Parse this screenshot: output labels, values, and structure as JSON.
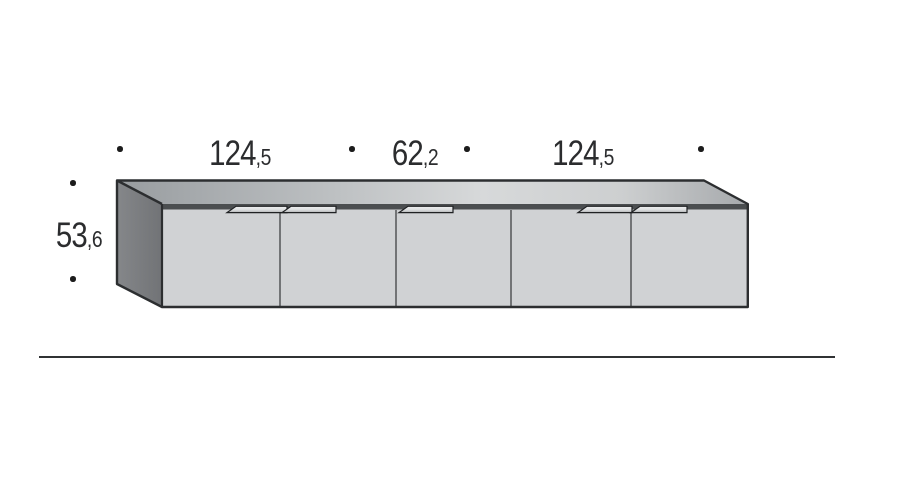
{
  "diagram": {
    "dimension_labels": {
      "top": [
        {
          "whole": "124",
          "decimal": ",5"
        },
        {
          "whole": "62",
          "decimal": ",2"
        },
        {
          "whole": "124",
          "decimal": ",5"
        }
      ],
      "height": {
        "whole": "53",
        "decimal": ",6"
      }
    },
    "cabinet": {
      "door_count": 5,
      "handle_count": 5
    },
    "colors": {
      "outline": "#2c2e30",
      "door_front": "#d0d2d4",
      "door_separator": "#4a4c4e",
      "side_panel_light": "#85878a",
      "side_panel_dark": "#717376",
      "top_edge_band": "#4b4e50",
      "top_gradient_left": "#989c9f",
      "top_gradient_mid": "#d7d9da",
      "top_gradient_right": "#a6a9ac",
      "handle_top": "#eff0f1",
      "handle_bottom": "#b0b2b4",
      "text": "#2b2c2e",
      "marker_dot": "#1c1c1c",
      "ground_line": "#303234",
      "background": "#ffffff"
    }
  }
}
